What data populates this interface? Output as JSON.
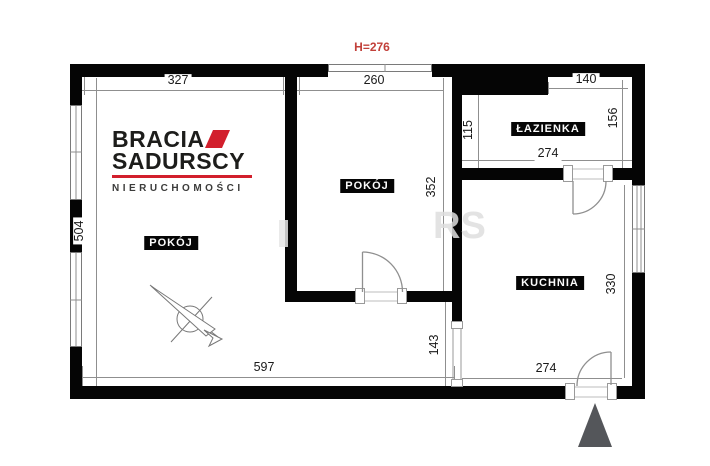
{
  "annotation": {
    "ceiling_height": "H=276"
  },
  "logo": {
    "brand_top": "BRACIA",
    "brand_bottom": "SADURSCY",
    "tagline": "NIERUCHOMOŚCI",
    "accent_color": "#d21f2c"
  },
  "rooms": {
    "room_left": "POKÓJ",
    "room_middle": "POKÓJ",
    "bathroom": "ŁAZIENKA",
    "kitchen": "KUCHNIA"
  },
  "dimensions_cm": {
    "room_left_top_width": "327",
    "room_middle_top_width": "260",
    "bathroom_top_width": "140",
    "bathroom_left_height": "115",
    "bathroom_right_height": "156",
    "bathroom_bottom_width": "274",
    "room_middle_right_height": "352",
    "left_wall_height": "504",
    "hall_height": "143",
    "kitchen_right_height": "330",
    "kitchen_bottom_width": "274",
    "bottom_width": "597"
  },
  "watermark": "RS",
  "colors": {
    "wall": "#050505",
    "dimension_line": "#8f8f8f",
    "annotation_red": "#c2403a",
    "entrance_marker": "#54565a",
    "logo_red": "#d21f2c"
  }
}
